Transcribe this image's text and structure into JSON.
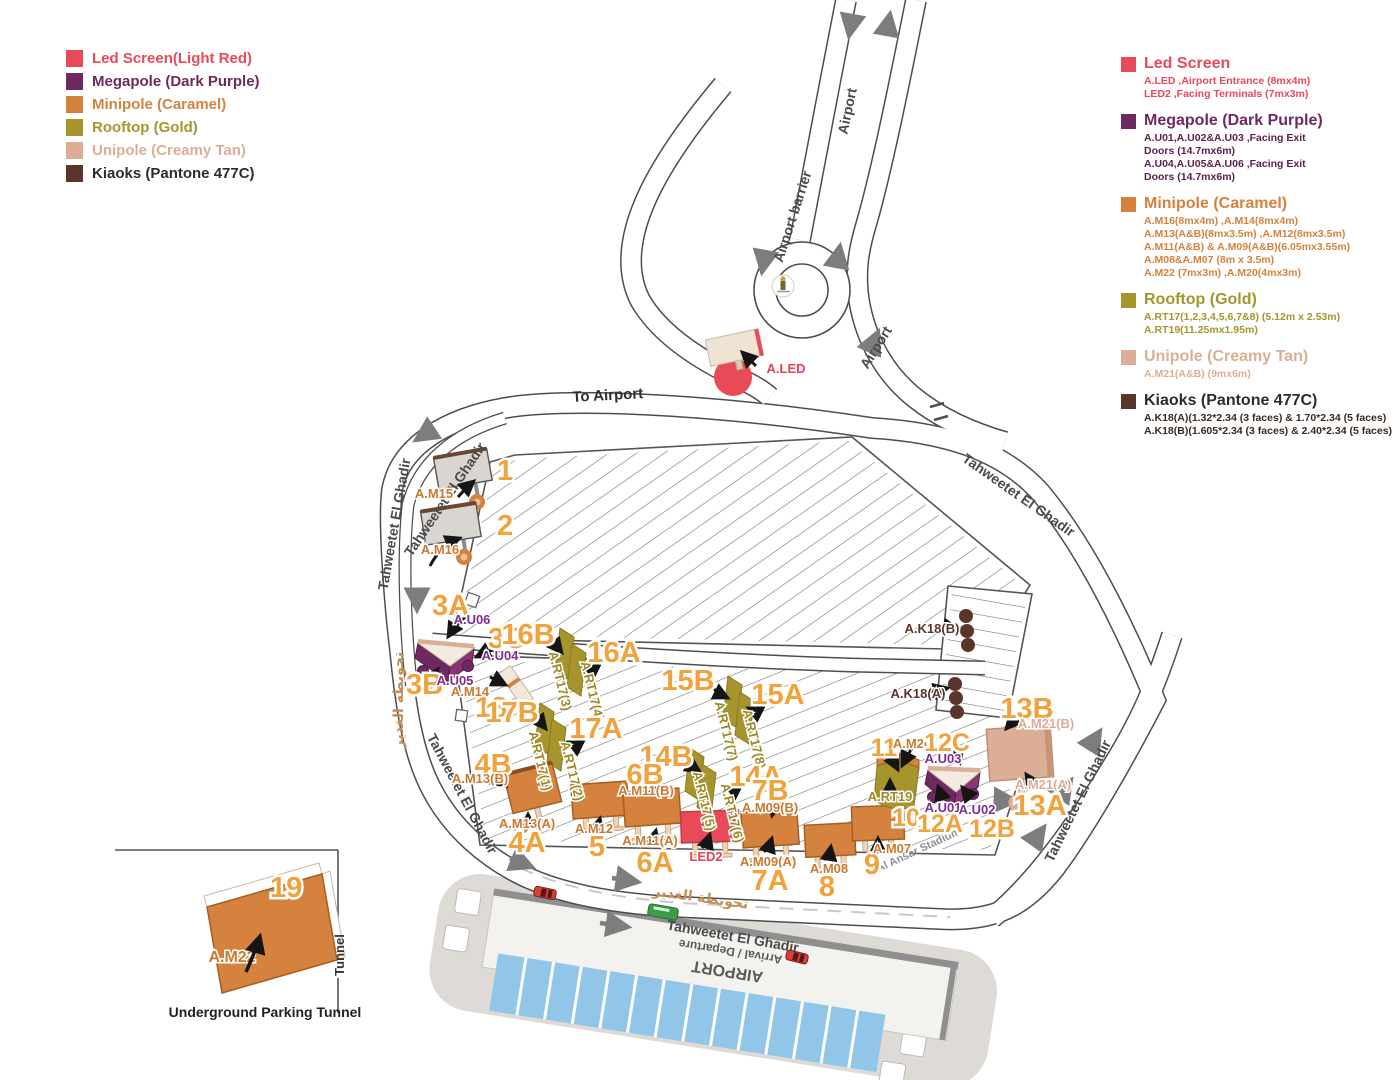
{
  "colors": {
    "light_red": "#E94A57",
    "dark_purple": "#6E2A60",
    "caramel": "#D4823E",
    "gold": "#A6952C",
    "creamy_tan": "#DCAE96",
    "kiaoks_477c": "#5B352B",
    "number_orange": "#F0A23C"
  },
  "legend_left": {
    "items": [
      {
        "label": "Led Screen(Light Red)",
        "color": "#E94A57"
      },
      {
        "label": "Megapole (Dark Purple)",
        "color": "#6E2A60"
      },
      {
        "label": "Minipole (Caramel)",
        "color": "#D4823E"
      },
      {
        "label": "Rooftop (Gold)",
        "color": "#A6952C"
      },
      {
        "label": "Unipole (Creamy Tan)",
        "color": "#DCAE96"
      },
      {
        "label": "Kiaoks (Pantone 477C)",
        "color": "#5B352B"
      }
    ]
  },
  "legend_right": {
    "sections": [
      {
        "title": "Led Screen",
        "color": "#E94A57",
        "lines": [
          "A.LED ,Airport Entrance (8mx4m)",
          "LED2 ,Facing Terminals  (7mx3m)"
        ]
      },
      {
        "title": "Megapole (Dark Purple)",
        "color": "#6E2A60",
        "lines": [
          "A.U01,A.U02&A.U03 ,Facing Exit",
          "Doors (14.7mx6m)",
          "A.U04,A.U05&A.U06 ,Facing Exit",
          "Doors (14.7mx6m)"
        ]
      },
      {
        "title": "Minipole (Caramel)",
        "color": "#D4823E",
        "lines": [
          "A.M16(8mx4m) ,A.M14(8mx4m)",
          "A.M13(A&B)(8mx3.5m) ,A.M12(8mx3.5m)",
          "A.M11(A&B) & A.M09(A&B)(6.05mx3.55m)",
          "A.M08&A.M07 (8m x 3.5m)",
          "A.M22 (7mx3m) ,A.M20(4mx3m)"
        ]
      },
      {
        "title": "Rooftop (Gold)",
        "color": "#A6952C",
        "lines": [
          "A.RT17(1,2,3,4,5,6,7&8) (5.12m x 2.53m)",
          "A.RT19(11.25mx1.95m)"
        ]
      },
      {
        "title": "Unipole (Creamy Tan)",
        "color": "#DCAE96",
        "lines": [
          "A.M21(A&B) (9mx6m)"
        ]
      },
      {
        "title": "Kiaoks (Pantone 477C)",
        "color": "#5B352B",
        "lines": [
          "A.K18(A)(1.32*2.34 (3 faces) & 1.70*2.34 (5 faces)",
          "A.K18(B)(1.605*2.34 (3 faces) & 2.40*2.34 (5 faces)"
        ]
      }
    ]
  },
  "map": {
    "road_labels": {
      "airport_top": "Airport",
      "airport_barrier": "Airport barrier",
      "airport_right": "Airport",
      "to_airport": "To Airport",
      "tahweetet": "Tahweetet El Ghadir",
      "tahweetet_ar": "تحويطة الغدير",
      "stadium": "Al Ansar Stadium"
    },
    "markers": {
      "m15": {
        "num": "1",
        "code": "A.M15"
      },
      "m16": {
        "num": "2",
        "code": "A.M16"
      },
      "u06": {
        "num": "3A",
        "code": "A.U06"
      },
      "u04": {
        "num": "3C",
        "code": "A.U04"
      },
      "u05": {
        "num": "3B",
        "code": "A.U05"
      },
      "m14": {
        "num": "18",
        "code": "A.M14"
      },
      "rt17_3": {
        "num": "16B",
        "code": "A.RT17(3)"
      },
      "rt17_4": {
        "num": "16A",
        "code": "A.RT17(4)"
      },
      "rt17_1": {
        "num": "17B",
        "code": "A.RT17(1)"
      },
      "rt17_2": {
        "num": "17A",
        "code": "A.RT17(2)"
      },
      "rt17_7": {
        "num": "15B",
        "code": "A.RT17(7)"
      },
      "rt17_8": {
        "num": "15A",
        "code": "A.RT17(8)"
      },
      "rt17_5": {
        "num": "14B",
        "code": "A.RT17(5)"
      },
      "rt17_6": {
        "num": "14A",
        "code": "A.RT17(6)"
      },
      "m13b": {
        "num": "4B",
        "code": "A.M13(B)"
      },
      "m13a": {
        "num": "4A",
        "code": "A.M13(A)"
      },
      "m12": {
        "num": "5",
        "code": "A.M12"
      },
      "m11b": {
        "num": "6B",
        "code": "A.M11(B)"
      },
      "m11a": {
        "num": "6A",
        "code": "A.M11(A)"
      },
      "led2": {
        "code": "LED2"
      },
      "m09b": {
        "num": "7B",
        "code": "A.M09(B)"
      },
      "m09a": {
        "num": "7A",
        "code": "A.M09(A)"
      },
      "m08": {
        "num": "8",
        "code": "A.M08"
      },
      "m07": {
        "num": "9",
        "code": "A.M07"
      },
      "m20": {
        "num": "11",
        "code": "A.M20"
      },
      "rt19": {
        "num": "10",
        "code": "A.RT19"
      },
      "u03": {
        "num": "12C",
        "code": "A.U03"
      },
      "u01": {
        "num": "12A",
        "code": "A.U01"
      },
      "u02": {
        "num": "12B",
        "code": "A.U02"
      },
      "m21b": {
        "num": "13B",
        "code": "A.M21(B)"
      },
      "m21a": {
        "num": "13A",
        "code": "A.M21(A)"
      },
      "k18b": {
        "code": "A.K18(B)"
      },
      "k18a": {
        "code": "A.K18(A)"
      },
      "aled": {
        "code": "A.LED"
      }
    },
    "tunnel": {
      "num": "19",
      "code": "A.M22",
      "side_label": "Tunnel",
      "caption": "Underground Parking Tunnel"
    },
    "terminal": {
      "line1": "AIRPORT",
      "line2": "Arrival / Departure"
    }
  }
}
